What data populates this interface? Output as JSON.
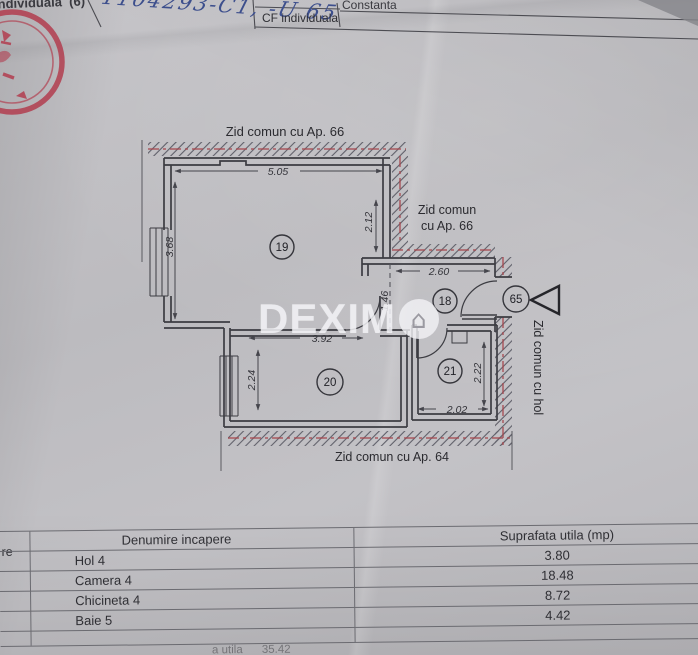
{
  "header": {
    "left_partial_label": "individuala  (6)",
    "handwritten_number": "1104293-C1, -U 65",
    "cf_label": "CF individuala",
    "county": "Constanta"
  },
  "plan": {
    "wall_labels": {
      "top": "Zid comun cu Ap. 66",
      "right_line1": "Zid comun",
      "right_line2": "cu Ap. 66",
      "bottom": "Zid comun cu Ap. 64",
      "hall": "Zid comun cu hol"
    },
    "room_numbers": {
      "camera": "19",
      "hol": "18",
      "chicineta": "20",
      "baie": "21"
    },
    "apartment_number": "65",
    "dimensions": {
      "camera_width": "5.05",
      "camera_right_depth": "2.12",
      "camera_left_depth": "3.68",
      "hol_width": "2.60",
      "hol_depth": "1.46",
      "chicineta_width": "3.92",
      "chicineta_depth": "2.24",
      "baie_depth": "2.22",
      "baie_width": "2.02"
    },
    "watermark": {
      "text": "DEXIMO",
      "prefix": "DEXIM"
    }
  },
  "table": {
    "stub_header_partial": "re",
    "columns": {
      "name": "Denumire incapere",
      "area": "Suprafata utila (mp)"
    },
    "rows": [
      {
        "name": "Hol 4",
        "area": "3.80"
      },
      {
        "name": "Camera 4",
        "area": "18.48"
      },
      {
        "name": "Chicineta 4",
        "area": "8.72"
      },
      {
        "name": "Baie 5",
        "area": "4.42"
      }
    ],
    "footer_partial": "a utila      35.42"
  },
  "colors": {
    "paper": "#c0bfc3",
    "ink": "#2f2f34",
    "stamp_red": "#b2394b",
    "wall_axis_red": "#a6484f",
    "handwriting_blue": "#3d4f8d"
  }
}
